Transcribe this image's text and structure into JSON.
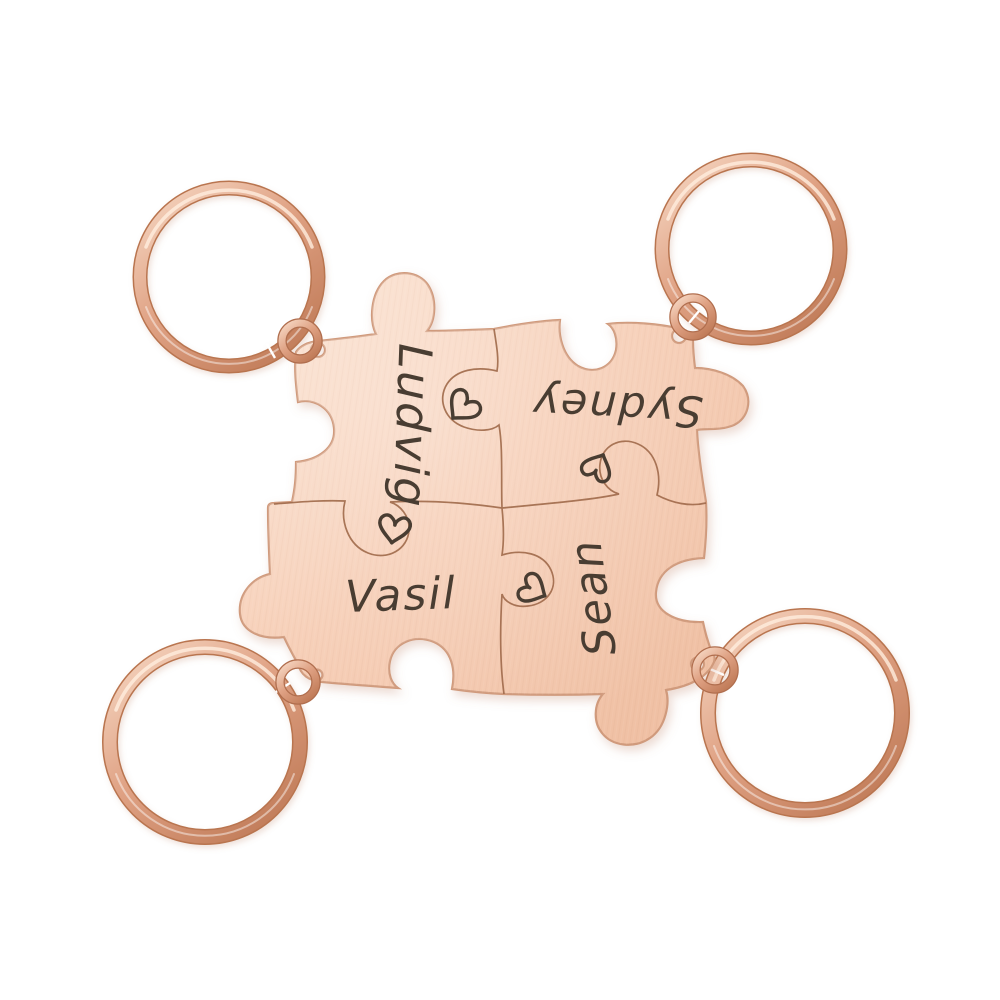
{
  "product_photo": {
    "alt_text": "Four rose gold puzzle piece keychains engraved with names and hearts",
    "names": [
      "Ludvig",
      "Sydney",
      "Vasil",
      "Sean"
    ],
    "pieces": [
      {
        "position": "top-left",
        "name": "Ludvig",
        "text_orientation": "rotated-90-reads-down"
      },
      {
        "position": "top-right",
        "name": "Sydney",
        "text_orientation": "rotated-180-upside-down"
      },
      {
        "position": "bottom-left",
        "name": "Vasil",
        "text_orientation": "horizontal"
      },
      {
        "position": "bottom-right",
        "name": "Sean",
        "text_orientation": "rotated-270-reads-up"
      }
    ],
    "heart_engraving_count": 4,
    "keyring_count": 4,
    "jump_ring_count": 4,
    "colors": {
      "background": "#ffffff",
      "metal_light": "#fbe3d2",
      "metal_mid": "#f6ccb3",
      "metal_deep": "#eebda0",
      "metal_edge": "#d09a7c",
      "ring_light": "#f7d9c5",
      "ring_mid": "#dfa183",
      "ring_dark": "#c17c59",
      "ring_rim": "#b9744f",
      "engraving": "#4a3e33",
      "seam_line": "#a06a4b"
    }
  }
}
